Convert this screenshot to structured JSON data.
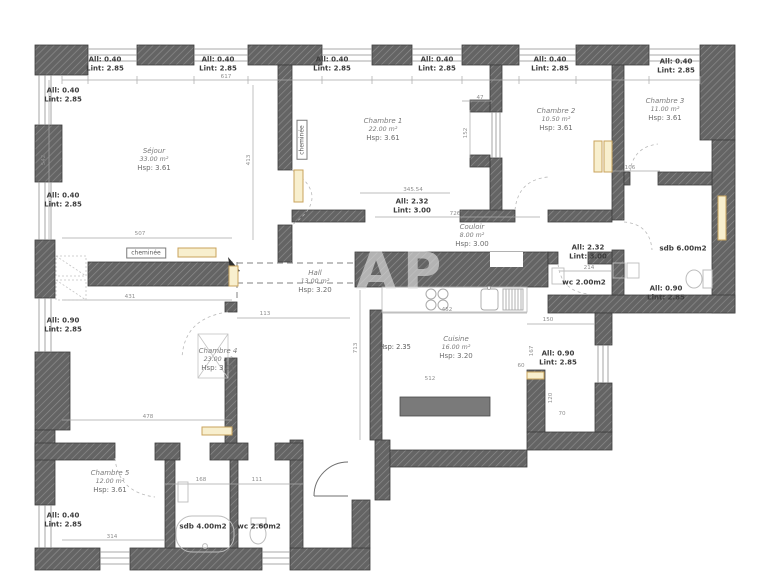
{
  "plan": {
    "watermark": "AP",
    "chimney_label": "cheminée",
    "ceiling_note": "Hsp: 2.35",
    "rooms": [
      {
        "name": "Séjour",
        "area": "33.00 m²",
        "height": "Hsp: 3.61"
      },
      {
        "name": "Chambre 1",
        "area": "22.00 m²",
        "height": "Hsp: 3.61"
      },
      {
        "name": "Chambre 2",
        "area": "10.50 m²",
        "height": "Hsp: 3.61"
      },
      {
        "name": "Chambre 3",
        "area": "11.00 m²",
        "height": "Hsp: 3.61"
      },
      {
        "name": "Chambre 4",
        "area": "23.00 m²",
        "height": "Hsp: 3.61"
      },
      {
        "name": "Chambre 5",
        "area": "12.00 m²",
        "height": "Hsp: 3.61"
      },
      {
        "name": "Couloir",
        "area": "8.00 m²",
        "height": "Hsp: 3.00"
      },
      {
        "name": "Hall",
        "area": "13.00 m²",
        "height": "Hsp: 3.20"
      },
      {
        "name": "Cuisine",
        "area": "16.00 m²",
        "height": "Hsp: 3.20"
      }
    ],
    "wet_rooms": [
      {
        "label": "sdb  4.00m2"
      },
      {
        "label": "wc  2.60m2"
      },
      {
        "label": "sdb  6.00m2"
      },
      {
        "label": "wc  2.00m2"
      }
    ],
    "openings": [
      {
        "all": "All: 0.40",
        "lint": "Lint: 2.85"
      },
      {
        "all": "All: 0.40",
        "lint": "Lint: 2.85"
      },
      {
        "all": "All: 0.40",
        "lint": "Lint: 2.85"
      },
      {
        "all": "All: 0.40",
        "lint": "Lint: 2.85"
      },
      {
        "all": "All: 0.40",
        "lint": "Lint: 2.85"
      },
      {
        "all": "All: 0.40",
        "lint": "Lint: 2.85"
      },
      {
        "all": "All: 0.40",
        "lint": "Lint: 2.85"
      },
      {
        "all": "All: 0.40",
        "lint": "Lint: 2.85"
      },
      {
        "all": "All: 0.90",
        "lint": "Lint: 2.85"
      },
      {
        "all": "All: 0.40",
        "lint": "Lint: 2.85"
      },
      {
        "all": "All: 2.32",
        "lint": "Lint: 3.00"
      },
      {
        "all": "All: 2.32",
        "lint": "Lint: 3.00"
      },
      {
        "all": "All: 0.90",
        "lint": "Lint: 2.85"
      },
      {
        "all": "All: 0.90",
        "lint": "Lint: 2.85"
      }
    ],
    "dimensions": [
      {
        "t": "617"
      },
      {
        "t": "542"
      },
      {
        "t": "507"
      },
      {
        "t": "431"
      },
      {
        "t": "345.54"
      },
      {
        "t": "726"
      },
      {
        "t": "413"
      },
      {
        "t": "152"
      },
      {
        "t": "47"
      },
      {
        "t": "113"
      },
      {
        "t": "478"
      },
      {
        "t": "314"
      },
      {
        "t": "168"
      },
      {
        "t": "111"
      },
      {
        "t": "452"
      },
      {
        "t": "512"
      },
      {
        "t": "713"
      },
      {
        "t": "150"
      },
      {
        "t": "60"
      },
      {
        "t": "120"
      },
      {
        "t": "70"
      },
      {
        "t": "167"
      },
      {
        "t": "106"
      },
      {
        "t": "214"
      }
    ],
    "colors": {
      "wall": "#646464",
      "wall_border": "#3d3d3d",
      "radiator_fill": "#f8efce",
      "radiator_stroke": "#c9a35c",
      "dim_line": "#a0a0a0",
      "dashed_line": "#808080",
      "room_text": "#7a7a7a",
      "label_text": "#3d3d3d"
    }
  }
}
